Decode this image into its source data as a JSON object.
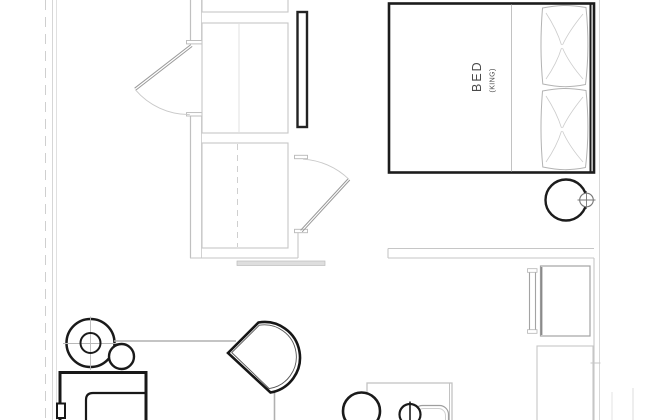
{
  "floor_plan": {
    "bed": {
      "label": "BED",
      "size": "(KING)"
    },
    "colors": {
      "background": "#ffffff",
      "furniture_line": "#1a1a1a",
      "wall_line": "#c6c6c6",
      "soft_line": "#b3b3b3",
      "label_text": "#4a4a4a",
      "threshold_fill": "#dedede"
    },
    "furniture": [
      {
        "name": "king-bed",
        "label": "BED (KING)"
      },
      {
        "name": "pillows"
      },
      {
        "name": "bedside-table"
      },
      {
        "name": "wall-sconce"
      },
      {
        "name": "wardrobe-closet-upper"
      },
      {
        "name": "wardrobe-closet-lower"
      },
      {
        "name": "full-length-mirror"
      },
      {
        "name": "entry-door"
      },
      {
        "name": "closet-door"
      },
      {
        "name": "minibar-cabinet"
      },
      {
        "name": "bathroom-enclosure"
      },
      {
        "name": "armchair"
      },
      {
        "name": "side-table-with-lamp"
      },
      {
        "name": "stool"
      },
      {
        "name": "lounge-chair"
      },
      {
        "name": "coffee-table"
      },
      {
        "name": "table-lamp"
      },
      {
        "name": "tub-rim"
      }
    ]
  }
}
